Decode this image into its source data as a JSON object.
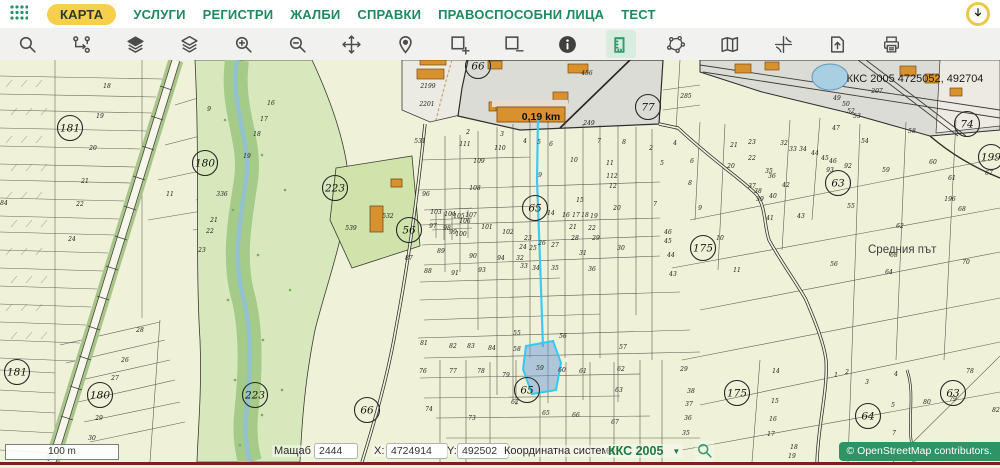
{
  "nav": {
    "items": [
      {
        "label": "КАРТА",
        "active": true
      },
      {
        "label": "УСЛУГИ",
        "active": false
      },
      {
        "label": "РЕГИСТРИ",
        "active": false
      },
      {
        "label": "ЖАЛБИ",
        "active": false
      },
      {
        "label": "СПРАВКИ",
        "active": false
      },
      {
        "label": "ПРАВОСПОСОБНИ ЛИЦА",
        "active": false
      },
      {
        "label": "ТЕСТ",
        "active": false
      }
    ]
  },
  "toolbar": {
    "tools": [
      "search",
      "layer-tree",
      "layers-filled",
      "layers-outline",
      "zoom-in",
      "zoom-out",
      "pan",
      "location",
      "area-add",
      "area-remove",
      "info",
      "measure",
      "polygon-select",
      "map-sheet",
      "coordinates",
      "export",
      "print"
    ],
    "active_tool": "measure"
  },
  "map": {
    "overlay_text": "ККС 2005 4725052, 492704",
    "measure_label": "0,19 km",
    "road_label": "Средния път",
    "scale_bar_label": "100 m",
    "selected_parcel": "59",
    "circled_numbers": [
      [
        70,
        68,
        "181"
      ],
      [
        205,
        103,
        "180"
      ],
      [
        335,
        128,
        "223"
      ],
      [
        409,
        170,
        "56"
      ],
      [
        535,
        148,
        "65"
      ],
      [
        648,
        47,
        "77"
      ],
      [
        703,
        188,
        "175"
      ],
      [
        838,
        123,
        "63"
      ],
      [
        967,
        64,
        "74"
      ],
      [
        991,
        97,
        "199"
      ],
      [
        478,
        6,
        "66"
      ],
      [
        17,
        312,
        "181"
      ],
      [
        100,
        335,
        "180"
      ],
      [
        255,
        335,
        "223"
      ],
      [
        367,
        350,
        "66"
      ],
      [
        527,
        330,
        "65"
      ],
      [
        737,
        333,
        "175"
      ],
      [
        868,
        356,
        "64"
      ],
      [
        953,
        333,
        "63"
      ]
    ],
    "parcel_labels": [
      [
        107,
        28,
        "18"
      ],
      [
        100,
        58,
        "19"
      ],
      [
        93,
        90,
        "20"
      ],
      [
        85,
        123,
        "21"
      ],
      [
        80,
        146,
        "22"
      ],
      [
        72,
        181,
        "24"
      ],
      [
        4,
        145,
        "84"
      ],
      [
        140,
        272,
        "28"
      ],
      [
        125,
        302,
        "26"
      ],
      [
        115,
        320,
        "27"
      ],
      [
        99,
        360,
        "29"
      ],
      [
        92,
        380,
        "30"
      ],
      [
        209,
        51,
        "9"
      ],
      [
        271,
        45,
        "16"
      ],
      [
        264,
        61,
        "17"
      ],
      [
        257,
        76,
        "18"
      ],
      [
        247,
        98,
        "19"
      ],
      [
        222,
        136,
        "336"
      ],
      [
        214,
        162,
        "21"
      ],
      [
        210,
        173,
        "22"
      ],
      [
        202,
        192,
        "23"
      ],
      [
        170,
        136,
        "11"
      ],
      [
        351,
        170,
        "539"
      ],
      [
        388,
        158,
        "532"
      ],
      [
        426,
        136,
        "96"
      ],
      [
        409,
        200,
        "87"
      ],
      [
        428,
        28,
        "2199"
      ],
      [
        427,
        46,
        "2201"
      ],
      [
        587,
        15,
        "456"
      ],
      [
        589,
        65,
        "249"
      ],
      [
        420,
        83,
        "531"
      ],
      [
        468,
        74,
        "2"
      ],
      [
        502,
        76,
        "3"
      ],
      [
        686,
        38,
        "285"
      ],
      [
        837,
        40,
        "49"
      ],
      [
        846,
        46,
        "50"
      ],
      [
        851,
        53,
        "52"
      ],
      [
        857,
        58,
        "53"
      ],
      [
        836,
        70,
        "47"
      ],
      [
        912,
        73,
        "58"
      ],
      [
        877,
        33,
        "207"
      ],
      [
        465,
        86,
        "111"
      ],
      [
        500,
        90,
        "110"
      ],
      [
        479,
        103,
        "109"
      ],
      [
        475,
        130,
        "108"
      ],
      [
        436,
        154,
        "103"
      ],
      [
        450,
        156,
        "104"
      ],
      [
        459,
        158,
        "105"
      ],
      [
        465,
        163,
        "106"
      ],
      [
        471,
        157,
        "107"
      ],
      [
        433,
        168,
        "97"
      ],
      [
        447,
        170,
        "98"
      ],
      [
        453,
        174,
        "99"
      ],
      [
        461,
        176,
        "100"
      ],
      [
        487,
        169,
        "101"
      ],
      [
        508,
        174,
        "102"
      ],
      [
        441,
        193,
        "89"
      ],
      [
        473,
        198,
        "90"
      ],
      [
        501,
        200,
        "94"
      ],
      [
        428,
        213,
        "88"
      ],
      [
        455,
        215,
        "91"
      ],
      [
        482,
        212,
        "93"
      ],
      [
        520,
        200,
        "32"
      ],
      [
        524,
        208,
        "33"
      ],
      [
        536,
        210,
        "34"
      ],
      [
        528,
        180,
        "23"
      ],
      [
        523,
        189,
        "24"
      ],
      [
        533,
        190,
        "25"
      ],
      [
        542,
        185,
        "26"
      ],
      [
        555,
        187,
        "27"
      ],
      [
        551,
        155,
        "14"
      ],
      [
        580,
        142,
        "15"
      ],
      [
        566,
        157,
        "16"
      ],
      [
        576,
        157,
        "17"
      ],
      [
        585,
        157,
        "18"
      ],
      [
        594,
        158,
        "19"
      ],
      [
        617,
        150,
        "20"
      ],
      [
        573,
        169,
        "21"
      ],
      [
        592,
        170,
        "22"
      ],
      [
        575,
        180,
        "28"
      ],
      [
        596,
        180,
        "29"
      ],
      [
        621,
        190,
        "30"
      ],
      [
        583,
        195,
        "31"
      ],
      [
        574,
        102,
        "10"
      ],
      [
        610,
        105,
        "11"
      ],
      [
        612,
        118,
        "112"
      ],
      [
        613,
        128,
        "12"
      ],
      [
        525,
        83,
        "4"
      ],
      [
        539,
        84,
        "5"
      ],
      [
        551,
        86,
        "6"
      ],
      [
        599,
        83,
        "7"
      ],
      [
        624,
        84,
        "8"
      ],
      [
        540,
        117,
        "9"
      ],
      [
        555,
        210,
        "35"
      ],
      [
        592,
        211,
        "36"
      ],
      [
        651,
        90,
        "2"
      ],
      [
        675,
        85,
        "4"
      ],
      [
        662,
        105,
        "5"
      ],
      [
        692,
        103,
        "6"
      ],
      [
        690,
        125,
        "8"
      ],
      [
        655,
        146,
        "7"
      ],
      [
        700,
        150,
        "9"
      ],
      [
        668,
        174,
        "46"
      ],
      [
        668,
        183,
        "45"
      ],
      [
        671,
        197,
        "44"
      ],
      [
        673,
        216,
        "43"
      ],
      [
        720,
        180,
        "10"
      ],
      [
        737,
        212,
        "11"
      ],
      [
        731,
        108,
        "20"
      ],
      [
        734,
        87,
        "21"
      ],
      [
        752,
        100,
        "22"
      ],
      [
        752,
        84,
        "23"
      ],
      [
        784,
        85,
        "32"
      ],
      [
        793,
        91,
        "33"
      ],
      [
        803,
        91,
        "34"
      ],
      [
        769,
        113,
        "35"
      ],
      [
        772,
        118,
        "36"
      ],
      [
        752,
        128,
        "37"
      ],
      [
        758,
        133,
        "38"
      ],
      [
        760,
        141,
        "39"
      ],
      [
        773,
        138,
        "40"
      ],
      [
        770,
        160,
        "41"
      ],
      [
        786,
        127,
        "42"
      ],
      [
        801,
        158,
        "43"
      ],
      [
        815,
        95,
        "44"
      ],
      [
        825,
        100,
        "45"
      ],
      [
        833,
        103,
        "46"
      ],
      [
        848,
        108,
        "92"
      ],
      [
        830,
        112,
        "93"
      ],
      [
        865,
        83,
        "54"
      ],
      [
        886,
        112,
        "59"
      ],
      [
        933,
        104,
        "60"
      ],
      [
        952,
        120,
        "61"
      ],
      [
        989,
        115,
        "67"
      ],
      [
        962,
        151,
        "68"
      ],
      [
        950,
        141,
        "196"
      ],
      [
        851,
        148,
        "55"
      ],
      [
        900,
        168,
        "62"
      ],
      [
        834,
        206,
        "56"
      ],
      [
        894,
        197,
        "63"
      ],
      [
        889,
        214,
        "64"
      ],
      [
        966,
        204,
        "70"
      ],
      [
        517,
        275,
        "55"
      ],
      [
        563,
        278,
        "56"
      ],
      [
        623,
        289,
        "57"
      ],
      [
        517,
        291,
        "58"
      ],
      [
        424,
        285,
        "81"
      ],
      [
        453,
        288,
        "82"
      ],
      [
        471,
        288,
        "83"
      ],
      [
        492,
        290,
        "84"
      ],
      [
        423,
        313,
        "76"
      ],
      [
        453,
        313,
        "77"
      ],
      [
        481,
        313,
        "78"
      ],
      [
        506,
        317,
        "79"
      ],
      [
        540,
        310,
        "59"
      ],
      [
        562,
        312,
        "60"
      ],
      [
        583,
        313,
        "61"
      ],
      [
        621,
        311,
        "62"
      ],
      [
        619,
        332,
        "63"
      ],
      [
        546,
        355,
        "65"
      ],
      [
        576,
        357,
        "66"
      ],
      [
        615,
        364,
        "67"
      ],
      [
        472,
        360,
        "73"
      ],
      [
        429,
        351,
        "74"
      ],
      [
        515,
        344,
        "62"
      ],
      [
        684,
        311,
        "29"
      ],
      [
        776,
        313,
        "14"
      ],
      [
        691,
        333,
        "38"
      ],
      [
        689,
        346,
        "37"
      ],
      [
        688,
        360,
        "36"
      ],
      [
        686,
        375,
        "35"
      ],
      [
        775,
        343,
        "15"
      ],
      [
        773,
        361,
        "16"
      ],
      [
        771,
        376,
        "17"
      ],
      [
        794,
        389,
        "18"
      ],
      [
        792,
        398,
        "19"
      ],
      [
        836,
        317,
        "1"
      ],
      [
        847,
        314,
        "2"
      ],
      [
        867,
        324,
        "3"
      ],
      [
        896,
        316,
        "4"
      ],
      [
        893,
        347,
        "5"
      ],
      [
        845,
        392,
        "6"
      ],
      [
        894,
        375,
        "7"
      ],
      [
        970,
        313,
        "78"
      ],
      [
        927,
        344,
        "80"
      ],
      [
        953,
        341,
        "79"
      ],
      [
        996,
        352,
        "82"
      ]
    ]
  },
  "statusbar": {
    "scale_label": "Мащаб 1:",
    "scale_value": "2444",
    "x_label": "X:",
    "x_value": "4724914",
    "y_label": "Y:",
    "y_value": "492502",
    "crs_label": "Координатна система:",
    "crs_value": "ККС 2005",
    "crs_caret": "▼",
    "attribution": "© OpenStreetMap contributors."
  },
  "colors": {
    "nav_green": "#1e8a5e",
    "pill_yellow": "#f6cf4d",
    "tool_active_green": "#2f9e6e",
    "measure_blue": "#3fc9f2",
    "selection_fill": "#6e9bd7",
    "crs_green": "#1d7a3f",
    "osm_badge_green": "#2e9465",
    "bottom_line_red": "#7b2125"
  }
}
